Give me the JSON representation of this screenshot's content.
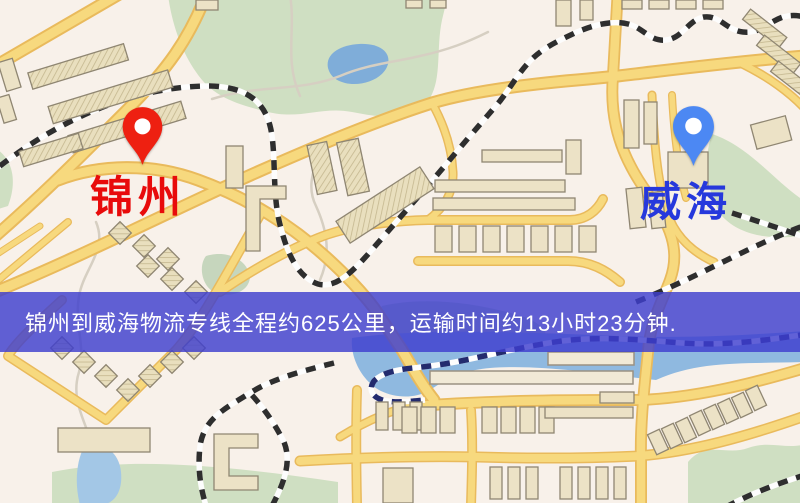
{
  "app": {
    "type": "map-screenshot"
  },
  "map": {
    "markers": [
      {
        "id": "origin",
        "label": "锦州",
        "icon": "red-location-pin-icon",
        "pin_color": "#ee2011",
        "label_color": "#e80b0b"
      },
      {
        "id": "destination",
        "label": "威海",
        "icon": "blue-location-pin-icon",
        "pin_color": "#4c88f3",
        "label_color": "#2638dc"
      }
    ]
  },
  "banner": {
    "text": "锦州到威海物流专线全程约625公里，运输时间约13小时23分钟.",
    "background_color": "#3e3ece",
    "text_color": "#ffffff"
  },
  "colors": {
    "map_background": "#f8f1ea",
    "road_fill": "#f7d97e",
    "road_casing": "#e9ba5c",
    "park_green": "#cfdfc2",
    "water_blue": "#8fb9e0",
    "building_fill": "#ece2c6",
    "building_outline": "#8f8672",
    "railway_dark": "#2e2e2e",
    "railway_navy": "#232b6e"
  }
}
